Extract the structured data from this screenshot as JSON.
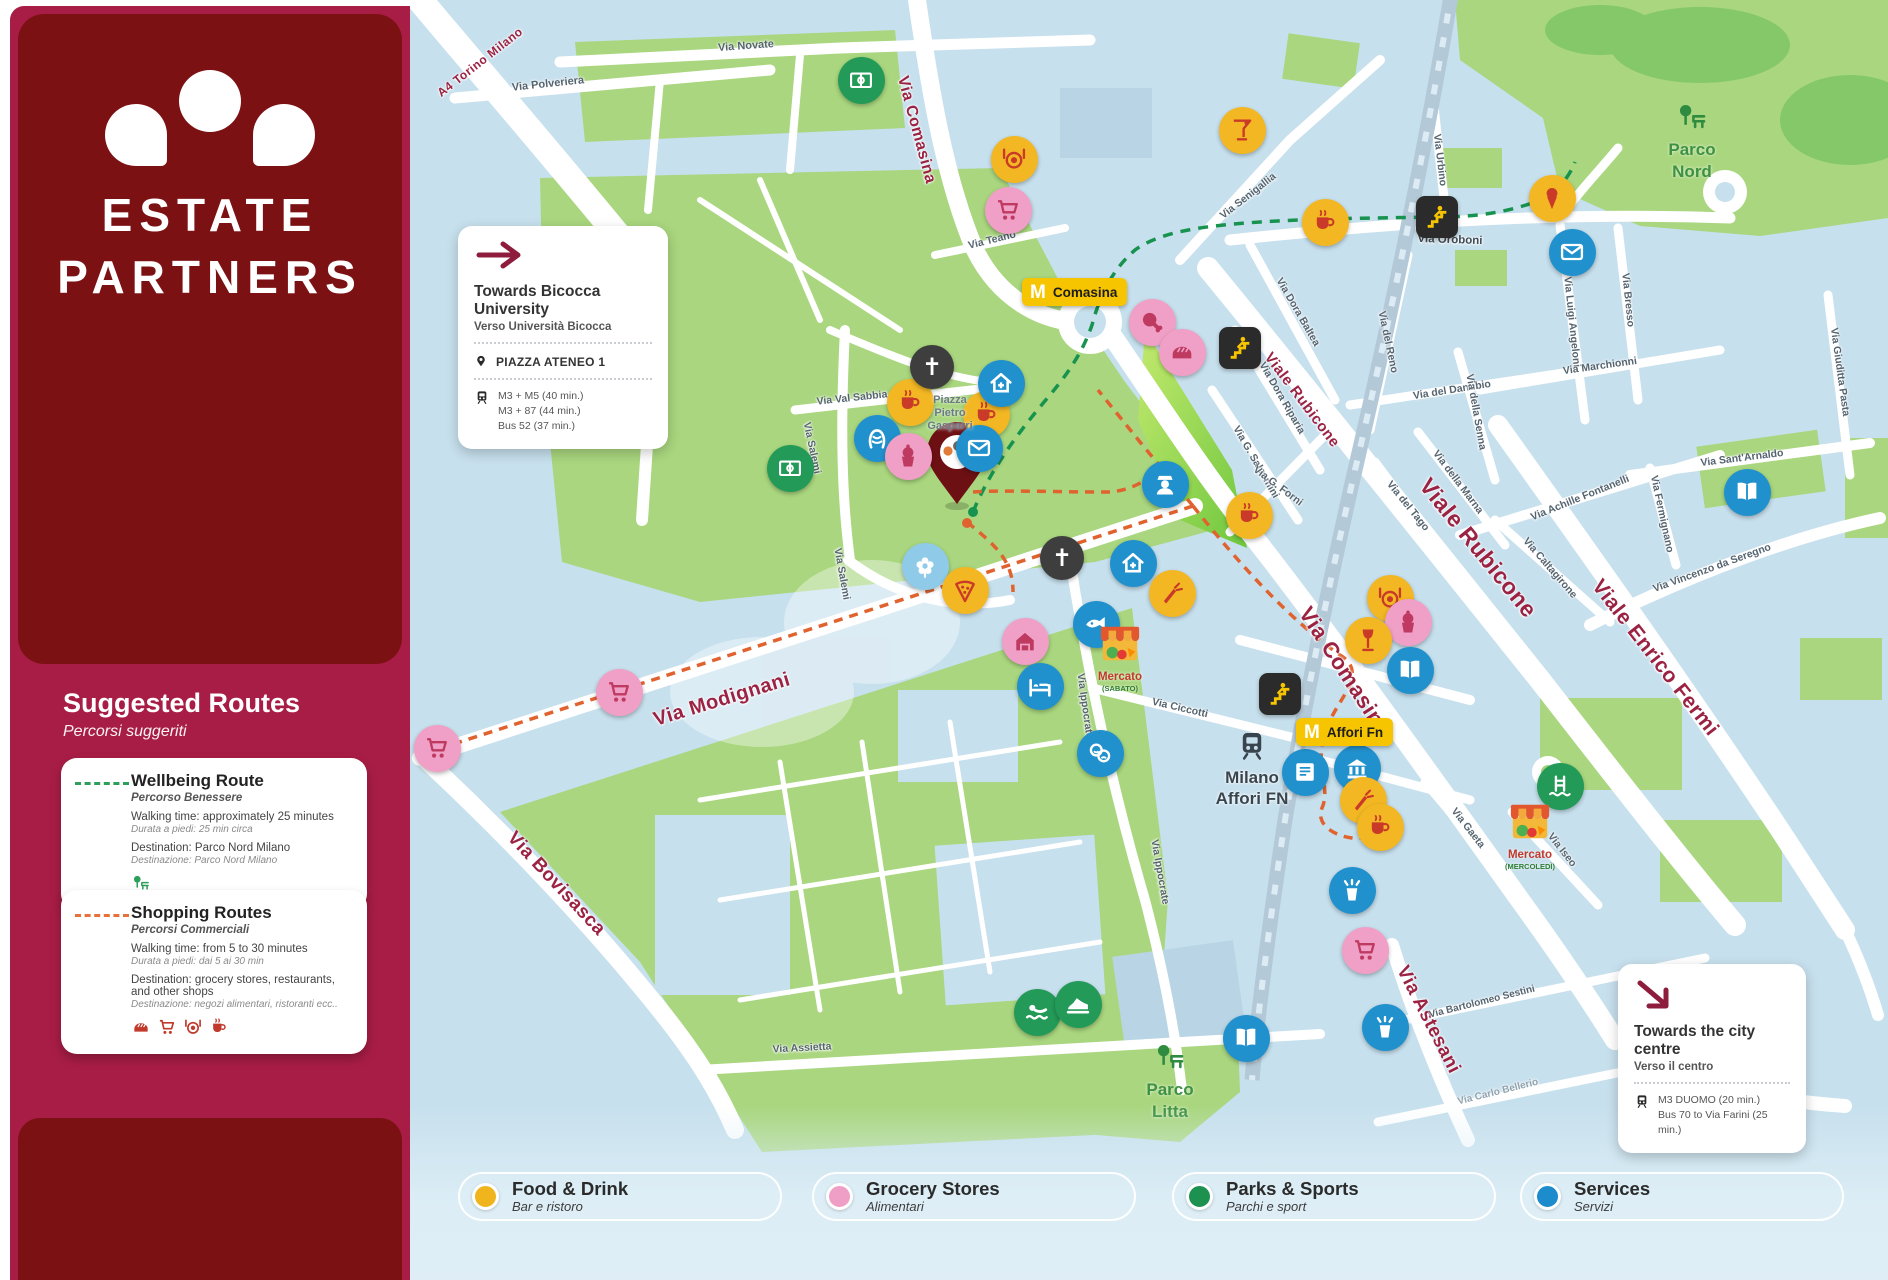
{
  "brand": {
    "line1": "ESTATE",
    "line2": "PARTNERS"
  },
  "sidebar": {
    "suggested_routes_title": "Suggested Routes",
    "suggested_routes_subtitle": "Percorsi suggeriti",
    "routes": [
      {
        "title": "Wellbeing Route",
        "subtitle": "Percorso Benessere",
        "line1": "Walking time: approximately 25 minutes",
        "line1_it": "Durata a piedi: 25 min circa",
        "line2": "Destination: Parco Nord Milano",
        "line2_it": "Destinazione: Parco Nord Milano",
        "dash_color": "#2e9e5b",
        "icon_color": "#2e9e5b",
        "icons": [
          "tree-bench"
        ]
      },
      {
        "title": "Shopping Routes",
        "subtitle": "Percorsi Commerciali",
        "line1": "Walking time: from 5 to 30 minutes",
        "line1_it": "Durata a piedi: dai 5 ai 30 min",
        "line2": "Destination: grocery stores, restaurants, and other shops",
        "line2_it": "Destinazione: negozi alimentari, ristoranti ecc..",
        "dash_color": "#e8703a",
        "icon_color": "#c0392b",
        "icons": [
          "bread",
          "cart",
          "restaurant",
          "coffee"
        ]
      }
    ]
  },
  "cards": {
    "bicocca": {
      "title": "Towards Bicocca University",
      "subtitle": "Verso Università Bicocca",
      "stop": "PIAZZA ATENEO 1",
      "transit": [
        "M3 + M5 (40 min.)",
        "M3 + 87 (44 min.)",
        "Bus 52 (37 min.)"
      ]
    },
    "city_centre": {
      "title": "Towards the city centre",
      "subtitle": "Verso il centro",
      "transit": [
        "M3 DUOMO (20 min.)",
        "Bus 70 to Via Farini (25 min.)"
      ]
    }
  },
  "legend": [
    {
      "label": "Food & Drink",
      "sublabel": "Bar e ristoro",
      "color": "#f0b51c",
      "x": 458
    },
    {
      "label": "Grocery Stores",
      "sublabel": "Alimentari",
      "color": "#ef9fc5",
      "x": 812
    },
    {
      "label": "Parks & Sports",
      "sublabel": "Parchi e sport",
      "color": "#1d9150",
      "x": 1172
    },
    {
      "label": "Services",
      "sublabel": "Servizi",
      "color": "#1d8ccc",
      "x": 1520
    }
  ],
  "map": {
    "route_colors": {
      "wellbeing": "#17934f",
      "shopping": "#e0632f"
    },
    "metro_stations": [
      {
        "label": "Comasina",
        "x": 1022,
        "y": 278
      },
      {
        "label": "Affori Fn",
        "x": 1296,
        "y": 718
      }
    ],
    "rail_station": {
      "line1": "Milano",
      "line2": "Affori FN",
      "x": 1252,
      "y": 728
    },
    "area_labels": [
      {
        "line1": "Parco",
        "line2": "Nord",
        "x": 1692,
        "y": 100,
        "icon_y": -44
      },
      {
        "line1": "Parco",
        "line2": "Litta",
        "x": 1170,
        "y": 1040,
        "icon_y": -46
      }
    ],
    "piazza_label": {
      "line1": "Piazza",
      "line2": "Pietro",
      "line3": "Gasparri",
      "x": 950,
      "y": 394
    },
    "stalls": [
      {
        "label": "Mercato",
        "sublabel": "(SABATO)",
        "x": 1120,
        "y": 622
      },
      {
        "label": "Mercato",
        "sublabel": "(MERCOLEDÌ)",
        "x": 1530,
        "y": 800
      }
    ],
    "streets": [
      {
        "text": "A4 Torino Milano",
        "x": 480,
        "y": 62,
        "rot": -38,
        "size": 12,
        "cls": "major"
      },
      {
        "text": "Via Comasina",
        "x": 916,
        "y": 130,
        "rot": 75,
        "size": 16,
        "cls": "major"
      },
      {
        "text": "Via Comasina",
        "x": 1345,
        "y": 672,
        "rot": 57,
        "size": 22,
        "cls": "major"
      },
      {
        "text": "Viale Rubicone",
        "x": 1302,
        "y": 400,
        "rot": 53,
        "size": 15,
        "cls": "major"
      },
      {
        "text": "Viale Rubicone",
        "x": 1478,
        "y": 548,
        "rot": 51,
        "size": 23,
        "cls": "major"
      },
      {
        "text": "Viale Enrico Fermi",
        "x": 1655,
        "y": 658,
        "rot": 52,
        "size": 21,
        "cls": "major"
      },
      {
        "text": "Via Modignani",
        "x": 722,
        "y": 700,
        "rot": -17,
        "size": 20,
        "cls": "major"
      },
      {
        "text": "Via Bovisasca",
        "x": 556,
        "y": 884,
        "rot": 47,
        "size": 19,
        "cls": "major"
      },
      {
        "text": "Via Astesani",
        "x": 1428,
        "y": 1020,
        "rot": 63,
        "size": 19,
        "cls": "major"
      },
      {
        "text": "Via Novate",
        "x": 746,
        "y": 46,
        "rot": -4,
        "size": 11,
        "cls": "minor"
      },
      {
        "text": "Via Polveriera",
        "x": 548,
        "y": 84,
        "rot": -6,
        "size": 11,
        "cls": "minor"
      },
      {
        "text": "Via Teano",
        "x": 992,
        "y": 240,
        "rot": -14,
        "size": 10.5,
        "cls": "minor"
      },
      {
        "text": "Via Senigallia",
        "x": 1248,
        "y": 196,
        "rot": -38,
        "size": 10.5,
        "cls": "minor"
      },
      {
        "text": "Via Urbino",
        "x": 1440,
        "y": 160,
        "rot": 83,
        "size": 10.5,
        "cls": "minor"
      },
      {
        "text": "Via Oroboni",
        "x": 1450,
        "y": 240,
        "rot": 2,
        "size": 11.5,
        "cls": "mid"
      },
      {
        "text": "Via Dora Baltea",
        "x": 1298,
        "y": 312,
        "rot": 60,
        "size": 10.5,
        "cls": "minor"
      },
      {
        "text": "Via Dora Riparia",
        "x": 1282,
        "y": 398,
        "rot": 60,
        "size": 10.5,
        "cls": "minor"
      },
      {
        "text": "Via G. Salvemini",
        "x": 1256,
        "y": 462,
        "rot": 60,
        "size": 10.5,
        "cls": "minor"
      },
      {
        "text": "Via del Reno",
        "x": 1388,
        "y": 342,
        "rot": 78,
        "size": 10.5,
        "cls": "minor"
      },
      {
        "text": "Via Luigi Angeloni",
        "x": 1572,
        "y": 322,
        "rot": 84,
        "size": 10.5,
        "cls": "minor"
      },
      {
        "text": "Via Bresso",
        "x": 1628,
        "y": 300,
        "rot": 84,
        "size": 10.5,
        "cls": "minor"
      },
      {
        "text": "Via Giuditta Pasta",
        "x": 1840,
        "y": 372,
        "rot": 82,
        "size": 10.5,
        "cls": "minor"
      },
      {
        "text": "Via Marchionni",
        "x": 1600,
        "y": 366,
        "rot": -8,
        "size": 10.5,
        "cls": "minor"
      },
      {
        "text": "Via del Danubio",
        "x": 1452,
        "y": 390,
        "rot": -9,
        "size": 10.5,
        "cls": "minor"
      },
      {
        "text": "Via della Senna",
        "x": 1476,
        "y": 412,
        "rot": 80,
        "size": 10.5,
        "cls": "minor"
      },
      {
        "text": "Via Sant'Arnaldo",
        "x": 1742,
        "y": 458,
        "rot": -7,
        "size": 10.5,
        "cls": "minor"
      },
      {
        "text": "Via Achille Fontanelli",
        "x": 1580,
        "y": 498,
        "rot": -22,
        "size": 10.5,
        "cls": "minor"
      },
      {
        "text": "Via Fermignano",
        "x": 1662,
        "y": 514,
        "rot": 78,
        "size": 10.5,
        "cls": "minor"
      },
      {
        "text": "Via Caltagirone",
        "x": 1550,
        "y": 568,
        "rot": 49,
        "size": 10.5,
        "cls": "minor"
      },
      {
        "text": "Via Vincenzo da Seregno",
        "x": 1712,
        "y": 568,
        "rot": -20,
        "size": 10.5,
        "cls": "minor"
      },
      {
        "text": "Via della Marna",
        "x": 1458,
        "y": 482,
        "rot": 53,
        "size": 10.5,
        "cls": "minor"
      },
      {
        "text": "Via del Tago",
        "x": 1408,
        "y": 506,
        "rot": 51,
        "size": 10.5,
        "cls": "minor"
      },
      {
        "text": "Via G. Forni",
        "x": 1278,
        "y": 486,
        "rot": 37,
        "size": 10.5,
        "cls": "minor"
      },
      {
        "text": "Via Val Sabbia",
        "x": 852,
        "y": 398,
        "rot": -6,
        "size": 10.5,
        "cls": "minor"
      },
      {
        "text": "Via Salemi",
        "x": 812,
        "y": 448,
        "rot": 78,
        "size": 10.5,
        "cls": "minor"
      },
      {
        "text": "Via Salemi",
        "x": 842,
        "y": 574,
        "rot": 80,
        "size": 10.5,
        "cls": "minor"
      },
      {
        "text": "Via Ippocrate",
        "x": 1085,
        "y": 706,
        "rot": 82,
        "size": 10.5,
        "cls": "minor"
      },
      {
        "text": "Via Ippocrate",
        "x": 1160,
        "y": 872,
        "rot": 80,
        "size": 10.5,
        "cls": "minor"
      },
      {
        "text": "Via Ciccotti",
        "x": 1180,
        "y": 708,
        "rot": 13,
        "size": 10.5,
        "cls": "minor"
      },
      {
        "text": "Via Assietta",
        "x": 802,
        "y": 1048,
        "rot": -3,
        "size": 10.5,
        "cls": "minor"
      },
      {
        "text": "Via Bartolomeo Sestini",
        "x": 1482,
        "y": 1002,
        "rot": -14,
        "size": 10,
        "cls": "minor"
      },
      {
        "text": "Via Carlo Bellerio",
        "x": 1498,
        "y": 1092,
        "rot": -14,
        "size": 10,
        "cls": "faint"
      },
      {
        "text": "Via Gaeta",
        "x": 1468,
        "y": 828,
        "rot": 52,
        "size": 10.5,
        "cls": "minor"
      },
      {
        "text": "Via Iseo",
        "x": 1562,
        "y": 850,
        "rot": 52,
        "size": 10.5,
        "cls": "minor"
      }
    ],
    "pois": [
      {
        "icon": "restaurant",
        "cat": "food",
        "x": 1014,
        "y": 159
      },
      {
        "icon": "cart",
        "cat": "grocery",
        "x": 1008,
        "y": 210
      },
      {
        "icon": "cocktail",
        "cat": "food",
        "x": 1242,
        "y": 130
      },
      {
        "icon": "icecream",
        "cat": "food",
        "x": 1552,
        "y": 198
      },
      {
        "icon": "coffee",
        "cat": "food",
        "x": 1325,
        "y": 222
      },
      {
        "icon": "mail",
        "cat": "service",
        "x": 1572,
        "y": 252
      },
      {
        "icon": "meat",
        "cat": "grocery",
        "x": 1152,
        "y": 322
      },
      {
        "icon": "bread",
        "cat": "grocery",
        "x": 1182,
        "y": 352
      },
      {
        "icon": "coffee",
        "cat": "food",
        "x": 910,
        "y": 402
      },
      {
        "icon": "coffee",
        "cat": "food",
        "x": 986,
        "y": 414
      },
      {
        "icon": "home-plus",
        "cat": "service",
        "x": 1001,
        "y": 383
      },
      {
        "icon": "salon",
        "cat": "service",
        "x": 877,
        "y": 438
      },
      {
        "icon": "pastry",
        "cat": "grocery",
        "x": 908,
        "y": 456
      },
      {
        "icon": "mail",
        "cat": "service",
        "x": 979,
        "y": 448
      },
      {
        "icon": "flower",
        "cat": "service-light",
        "x": 925,
        "y": 566
      },
      {
        "icon": "pizza",
        "cat": "food",
        "x": 965,
        "y": 590
      },
      {
        "icon": "home-plus",
        "cat": "service",
        "x": 1133,
        "y": 563
      },
      {
        "icon": "carrot",
        "cat": "food",
        "x": 1172,
        "y": 593
      },
      {
        "icon": "police",
        "cat": "service",
        "x": 1165,
        "y": 484
      },
      {
        "icon": "coffee",
        "cat": "food",
        "x": 1249,
        "y": 515
      },
      {
        "icon": "market-house",
        "cat": "grocery",
        "x": 1025,
        "y": 641
      },
      {
        "icon": "fish",
        "cat": "service",
        "x": 1096,
        "y": 624
      },
      {
        "icon": "bed",
        "cat": "service",
        "x": 1040,
        "y": 686
      },
      {
        "icon": "theater",
        "cat": "service",
        "x": 1100,
        "y": 753
      },
      {
        "icon": "cart",
        "cat": "grocery",
        "x": 619,
        "y": 692
      },
      {
        "icon": "cart",
        "cat": "grocery",
        "x": 437,
        "y": 748
      },
      {
        "icon": "field",
        "cat": "park",
        "x": 861,
        "y": 80
      },
      {
        "icon": "field",
        "cat": "park",
        "x": 790,
        "y": 468
      },
      {
        "icon": "restaurant",
        "cat": "food",
        "x": 1390,
        "y": 598
      },
      {
        "icon": "pastry",
        "cat": "grocery",
        "x": 1408,
        "y": 622
      },
      {
        "icon": "wine",
        "cat": "food",
        "x": 1368,
        "y": 640
      },
      {
        "icon": "book",
        "cat": "service",
        "x": 1410,
        "y": 670
      },
      {
        "icon": "book",
        "cat": "service",
        "x": 1747,
        "y": 492
      },
      {
        "icon": "newspaper",
        "cat": "service",
        "x": 1305,
        "y": 772
      },
      {
        "icon": "bank",
        "cat": "service",
        "x": 1357,
        "y": 768
      },
      {
        "icon": "carrot",
        "cat": "food",
        "x": 1363,
        "y": 800
      },
      {
        "icon": "coffee",
        "cat": "food",
        "x": 1380,
        "y": 827
      },
      {
        "icon": "waste-bin",
        "cat": "service",
        "x": 1352,
        "y": 890
      },
      {
        "icon": "cart",
        "cat": "grocery",
        "x": 1365,
        "y": 950
      },
      {
        "icon": "waste-bin",
        "cat": "service",
        "x": 1385,
        "y": 1027
      },
      {
        "icon": "book",
        "cat": "service",
        "x": 1246,
        "y": 1038
      },
      {
        "icon": "swim",
        "cat": "park",
        "x": 1037,
        "y": 1012
      },
      {
        "icon": "sneaker",
        "cat": "park",
        "x": 1078,
        "y": 1004
      },
      {
        "icon": "pool-ladder",
        "cat": "park",
        "x": 1560,
        "y": 786
      },
      {
        "icon": "church",
        "cat": "church",
        "x": 932,
        "y": 367
      },
      {
        "icon": "church",
        "cat": "church",
        "x": 1062,
        "y": 558
      },
      {
        "icon": "stairs",
        "cat": "stairs",
        "x": 1437,
        "y": 217
      },
      {
        "icon": "stairs",
        "cat": "stairs",
        "x": 1240,
        "y": 348
      },
      {
        "icon": "stairs",
        "cat": "stairs",
        "x": 1280,
        "y": 694
      }
    ]
  }
}
